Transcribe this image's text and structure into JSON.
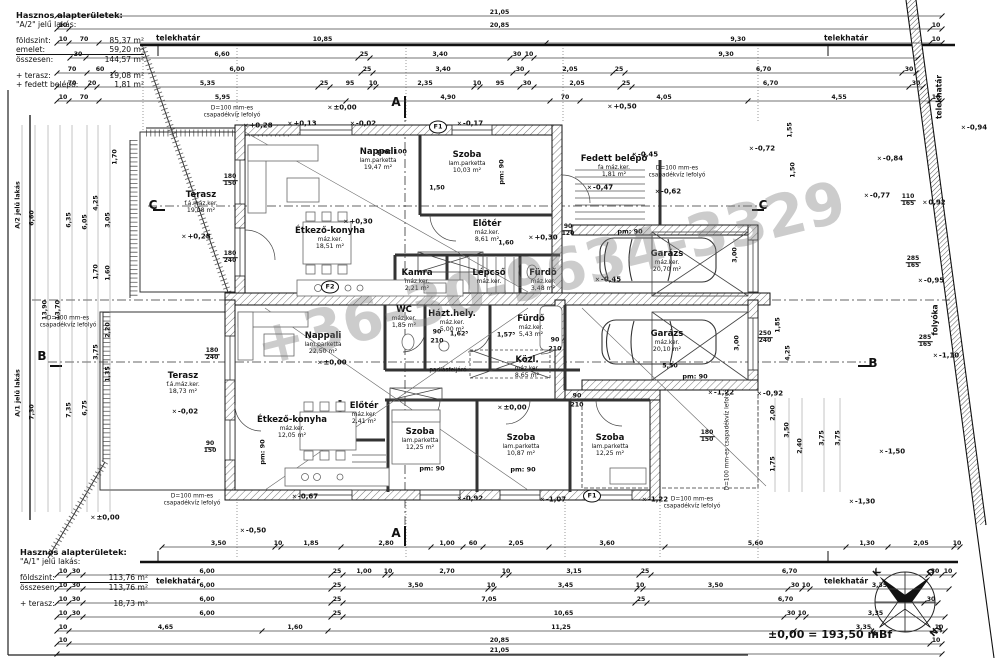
{
  "watermark": {
    "text": "+36-30-9634-3329"
  },
  "datum_note": "±0,00 = 193,50 mBf",
  "info_top": {
    "title": "Hasznos alapterületek:",
    "subtitle": "\"A/2\" jelű lakás:",
    "rows": [
      {
        "label": "földszint:",
        "value": "85,37 m²",
        "underline": false
      },
      {
        "label": "emelet:",
        "value": "59,20 m²",
        "underline": true
      },
      {
        "label": "összesen:",
        "value": "144,57 m²",
        "underline": false
      }
    ],
    "extras": [
      {
        "label": "+ terasz:",
        "value": "19,08 m²"
      },
      {
        "label": "+ fedett belépő:",
        "value": "1,81 m²"
      }
    ]
  },
  "info_bottom": {
    "title": "Hasznos alapterületek:",
    "subtitle": "\"A/1\" jelű lakás:",
    "rows": [
      {
        "label": "földszint:",
        "value": "113,76 m²",
        "underline": true
      },
      {
        "label": "összesen:",
        "value": "113,76 m²",
        "underline": false
      }
    ],
    "extras": [
      {
        "label": "+ terasz:",
        "value": "18,73 m²"
      }
    ]
  },
  "compass": {
    "n": "É",
    "e": "K",
    "s": "D",
    "w": "Ny"
  },
  "rooms": [
    {
      "n": "Nappali",
      "f": "lam.parketta",
      "a": "19,47 m²",
      "x": 378,
      "y": 160
    },
    {
      "n": "Szoba",
      "f": "lam.parketta",
      "a": "10,03 m²",
      "x": 467,
      "y": 163
    },
    {
      "n": "Étkező-konyha",
      "f": "máz.ker.",
      "a": "18,51 m²",
      "x": 330,
      "y": 239
    },
    {
      "n": "Előtér",
      "f": "máz.ker.",
      "a": "8,61 m²",
      "x": 487,
      "y": 232
    },
    {
      "n": "Kamra",
      "f": "máz.ker.",
      "a": "2,21 m²",
      "x": 417,
      "y": 281
    },
    {
      "n": "Lépcső",
      "f": "máz.ker.",
      "a": "",
      "x": 489,
      "y": 277
    },
    {
      "n": "Fürdő",
      "f": "máz.ker.",
      "a": "3,48 m²",
      "x": 543,
      "y": 281
    },
    {
      "n": "Fedett belépő",
      "f": "fa máz.ker.",
      "a": "1,81 m²",
      "x": 614,
      "y": 167
    },
    {
      "n": "Garázs",
      "f": "máz.ker.",
      "a": "20,70 m²",
      "x": 667,
      "y": 262
    },
    {
      "n": "Garázs",
      "f": "máz.ker.",
      "a": "20,10 m²",
      "x": 667,
      "y": 342
    },
    {
      "n": "Terasz",
      "f": "f.á.máz.ker.",
      "a": "19,08 m²",
      "x": 201,
      "y": 203
    },
    {
      "n": "Terasz",
      "f": "f.á.máz.ker.",
      "a": "18,73 m²",
      "x": 183,
      "y": 384
    },
    {
      "n": "Nappali",
      "f": "lam.parketta",
      "a": "22,50 m²",
      "x": 323,
      "y": 344
    },
    {
      "n": "Étkező-konyha",
      "f": "máz.ker.",
      "a": "12,05 m²",
      "x": 292,
      "y": 428
    },
    {
      "n": "Előtér",
      "f": "máz.ker.",
      "a": "2,41 m²",
      "x": 364,
      "y": 414
    },
    {
      "n": "WC",
      "f": "máz.ker.",
      "a": "1,85 m²",
      "x": 404,
      "y": 318
    },
    {
      "n": "Házt.hely.",
      "f": "máz.ker.",
      "a": "5,00 m²",
      "x": 452,
      "y": 322
    },
    {
      "n": "Fürdő",
      "f": "máz.ker.",
      "a": "5,43 m²",
      "x": 531,
      "y": 327
    },
    {
      "n": "Közl.",
      "f": "máz.ker.",
      "a": "8,65 m²",
      "x": 527,
      "y": 368
    },
    {
      "n": "Szoba",
      "f": "lam.parketta",
      "a": "12,25 m²",
      "x": 420,
      "y": 440
    },
    {
      "n": "Szoba",
      "f": "lam.parketta",
      "a": "10,87 m²",
      "x": 521,
      "y": 446
    },
    {
      "n": "Szoba",
      "f": "lam.parketta",
      "a": "12,25 m²",
      "x": 610,
      "y": 446
    }
  ],
  "levels": [
    {
      "t": "+0,28",
      "x": 258,
      "y": 126
    },
    {
      "t": "+0,13",
      "x": 302,
      "y": 124
    },
    {
      "t": "-0,02",
      "x": 363,
      "y": 124
    },
    {
      "t": "-0,17",
      "x": 470,
      "y": 124
    },
    {
      "t": "±0,00",
      "x": 342,
      "y": 108
    },
    {
      "t": "+0,50",
      "x": 622,
      "y": 107
    },
    {
      "t": "+0,30",
      "x": 358,
      "y": 222
    },
    {
      "t": "+0,28",
      "x": 196,
      "y": 237
    },
    {
      "t": "-0,02",
      "x": 185,
      "y": 412
    },
    {
      "t": "+0,30",
      "x": 543,
      "y": 238
    },
    {
      "t": "-0,45",
      "x": 608,
      "y": 280
    },
    {
      "t": "-0,47",
      "x": 600,
      "y": 188
    },
    {
      "t": "-0,62",
      "x": 668,
      "y": 192
    },
    {
      "t": "-0,72",
      "x": 762,
      "y": 149
    },
    {
      "t": "-0,84",
      "x": 890,
      "y": 159
    },
    {
      "t": "-0,94",
      "x": 974,
      "y": 128
    },
    {
      "t": "-0,77",
      "x": 877,
      "y": 196
    },
    {
      "t": "-0,95",
      "x": 931,
      "y": 281
    },
    {
      "t": "-1,10",
      "x": 946,
      "y": 356
    },
    {
      "t": "-1,50",
      "x": 892,
      "y": 452
    },
    {
      "t": "±0,00",
      "x": 512,
      "y": 408
    },
    {
      "t": "±0,00",
      "x": 332,
      "y": 363
    },
    {
      "t": "-0,50",
      "x": 253,
      "y": 531
    },
    {
      "t": "-0,67",
      "x": 305,
      "y": 497
    },
    {
      "t": "-0,92",
      "x": 470,
      "y": 499
    },
    {
      "t": "-1,07",
      "x": 553,
      "y": 500
    },
    {
      "t": "-1,22",
      "x": 655,
      "y": 500
    },
    {
      "t": "-1,22",
      "x": 721,
      "y": 393
    },
    {
      "t": "-0,92",
      "x": 770,
      "y": 394
    },
    {
      "t": "-1,30",
      "x": 862,
      "y": 502
    },
    {
      "t": "±0,00",
      "x": 105,
      "y": 518
    },
    {
      "t": "-0,45",
      "x": 645,
      "y": 155
    },
    {
      "t": "0,92",
      "x": 934,
      "y": 203
    }
  ],
  "texts": [
    {
      "t": "telekhatár",
      "x": 178,
      "y": 39,
      "cls": "site"
    },
    {
      "t": "telekhatár",
      "x": 846,
      "y": 39,
      "cls": "site"
    },
    {
      "t": "telekhatár",
      "x": 178,
      "y": 582,
      "cls": "site"
    },
    {
      "t": "telekhatár",
      "x": 846,
      "y": 582,
      "cls": "site"
    },
    {
      "t": "telekhatár",
      "x": 940,
      "y": 97,
      "cls": "site",
      "v": 1
    },
    {
      "t": "folyóka",
      "x": 936,
      "y": 320,
      "cls": "site",
      "v": 1
    },
    {
      "t": "D=100 mm-es\ncsapadékvíz lefolyó",
      "x": 232,
      "y": 112,
      "cls": "note"
    },
    {
      "t": "D=100 mm-es\ncsapadékvíz lefolyó",
      "x": 677,
      "y": 172,
      "cls": "note"
    },
    {
      "t": "D=100 mm-es\ncsapadékvíz lefolyó",
      "x": 68,
      "y": 322,
      "cls": "note"
    },
    {
      "t": "D=100 mm-es\ncsapadékvíz lefolyó",
      "x": 192,
      "y": 500,
      "cls": "note"
    },
    {
      "t": "D=100 mm-es\ncsapadékvíz lefolyó",
      "x": 692,
      "y": 503,
      "cls": "note"
    },
    {
      "t": "D=100 mm-es\ncsapadékvíz lefolyó",
      "x": 728,
      "y": 440,
      "cls": "note",
      "v": 1
    },
    {
      "t": "padlásfeljáró",
      "x": 448,
      "y": 371,
      "cls": "note"
    },
    {
      "t": "pm: 100",
      "x": 392,
      "y": 152,
      "cls": "pm"
    },
    {
      "t": "pm: 90",
      "x": 630,
      "y": 232,
      "cls": "pm"
    },
    {
      "t": "pm: 90",
      "x": 432,
      "y": 469,
      "cls": "pm"
    },
    {
      "t": "pm: 90",
      "x": 523,
      "y": 470,
      "cls": "pm"
    },
    {
      "t": "pm: 90",
      "x": 695,
      "y": 377,
      "cls": "pm"
    },
    {
      "t": "pm: 90",
      "x": 502,
      "y": 172,
      "cls": "pm",
      "v": 1
    },
    {
      "t": "pm: 90",
      "x": 263,
      "y": 452,
      "cls": "pm",
      "v": 1
    },
    {
      "t": "1,50",
      "x": 437,
      "y": 188,
      "cls": "dimtxt"
    },
    {
      "t": "1,62⁵",
      "x": 459,
      "y": 334,
      "cls": "dimtxt"
    },
    {
      "t": "1,57⁵",
      "x": 506,
      "y": 335,
      "cls": "dimtxt"
    },
    {
      "t": "5,50",
      "x": 670,
      "y": 366,
      "cls": "dimtxt"
    },
    {
      "t": "1,60",
      "x": 506,
      "y": 243,
      "cls": "dimtxt"
    },
    {
      "t": "90",
      "x": 555,
      "y": 340,
      "cls": "dimtxt"
    },
    {
      "t": "210",
      "x": 555,
      "y": 349,
      "cls": "dimtxt"
    },
    {
      "t": "90",
      "x": 577,
      "y": 396,
      "cls": "dimtxt"
    },
    {
      "t": "210",
      "x": 577,
      "y": 405,
      "cls": "dimtxt"
    },
    {
      "t": "90",
      "x": 437,
      "y": 332,
      "cls": "dimtxt"
    },
    {
      "t": "210",
      "x": 437,
      "y": 341,
      "cls": "dimtxt"
    },
    {
      "t": "A/2 jelű lakás",
      "x": 18,
      "y": 205,
      "cls": "dimtxt",
      "v": 1
    },
    {
      "t": "6,60",
      "x": 32,
      "y": 218,
      "cls": "dimtxt",
      "v": 1
    },
    {
      "t": "13,90",
      "x": 45,
      "y": 310,
      "cls": "dimtxt",
      "v": 1
    },
    {
      "t": "13,70",
      "x": 58,
      "y": 310,
      "cls": "dimtxt",
      "v": 1
    },
    {
      "t": "6,35",
      "x": 69,
      "y": 220,
      "cls": "dimtxt",
      "v": 1
    },
    {
      "t": "6,05",
      "x": 85,
      "y": 222,
      "cls": "dimtxt",
      "v": 1
    },
    {
      "t": "4,25",
      "x": 96,
      "y": 203,
      "cls": "dimtxt",
      "v": 1
    },
    {
      "t": "3,05",
      "x": 108,
      "y": 220,
      "cls": "dimtxt",
      "v": 1
    },
    {
      "t": "1,70",
      "x": 96,
      "y": 272,
      "cls": "dimtxt",
      "v": 1
    },
    {
      "t": "1,60",
      "x": 108,
      "y": 273,
      "cls": "dimtxt",
      "v": 1
    },
    {
      "t": "1,70",
      "x": 115,
      "y": 157,
      "cls": "dimtxt",
      "v": 1
    },
    {
      "t": "A/1 jelű lakás",
      "x": 18,
      "y": 393,
      "cls": "dimtxt",
      "v": 1
    },
    {
      "t": "7,30",
      "x": 32,
      "y": 412,
      "cls": "dimtxt",
      "v": 1
    },
    {
      "t": "7,35",
      "x": 69,
      "y": 410,
      "cls": "dimtxt",
      "v": 1
    },
    {
      "t": "6,75",
      "x": 85,
      "y": 408,
      "cls": "dimtxt",
      "v": 1
    },
    {
      "t": "3,75",
      "x": 96,
      "y": 352,
      "cls": "dimtxt",
      "v": 1
    },
    {
      "t": "2,20",
      "x": 108,
      "y": 330,
      "cls": "dimtxt",
      "v": 1
    },
    {
      "t": "1,35",
      "x": 108,
      "y": 374,
      "cls": "dimtxt",
      "v": 1
    },
    {
      "t": "2,00",
      "x": 773,
      "y": 413,
      "cls": "dimtxt",
      "v": 1
    },
    {
      "t": "3,50",
      "x": 787,
      "y": 430,
      "cls": "dimtxt",
      "v": 1
    },
    {
      "t": "2,40",
      "x": 800,
      "y": 446,
      "cls": "dimtxt",
      "v": 1
    },
    {
      "t": "3,75",
      "x": 822,
      "y": 438,
      "cls": "dimtxt",
      "v": 1
    },
    {
      "t": "3,75",
      "x": 838,
      "y": 438,
      "cls": "dimtxt",
      "v": 1
    },
    {
      "t": "1,75",
      "x": 773,
      "y": 464,
      "cls": "dimtxt",
      "v": 1
    },
    {
      "t": "1,55",
      "x": 790,
      "y": 130,
      "cls": "dimtxt",
      "v": 1
    },
    {
      "t": "1,50",
      "x": 793,
      "y": 170,
      "cls": "dimtxt",
      "v": 1
    },
    {
      "t": "1,85",
      "x": 778,
      "y": 325,
      "cls": "dimtxt",
      "v": 1
    },
    {
      "t": "4,25",
      "x": 788,
      "y": 353,
      "cls": "dimtxt",
      "v": 1
    },
    {
      "t": "3,00",
      "x": 737,
      "y": 343,
      "cls": "dimtxt",
      "v": 1
    },
    {
      "t": "3,00",
      "x": 735,
      "y": 255,
      "cls": "dimtxt",
      "v": 1
    }
  ],
  "fractions": [
    {
      "a": "180",
      "b": "150",
      "x": 230,
      "y": 181
    },
    {
      "a": "180",
      "b": "240",
      "x": 230,
      "y": 258
    },
    {
      "a": "180",
      "b": "240",
      "x": 212,
      "y": 355
    },
    {
      "a": "90",
      "b": "150",
      "x": 210,
      "y": 448
    },
    {
      "a": "110",
      "b": "165",
      "x": 908,
      "y": 201
    },
    {
      "a": "285",
      "b": "165",
      "x": 913,
      "y": 263
    },
    {
      "a": "285",
      "b": "165",
      "x": 925,
      "y": 342
    },
    {
      "a": "250",
      "b": "240",
      "x": 765,
      "y": 338
    },
    {
      "a": "90",
      "b": "120",
      "x": 568,
      "y": 231
    },
    {
      "a": "180",
      "b": "150",
      "x": 707,
      "y": 437
    }
  ],
  "circles": [
    {
      "t": "F1",
      "x": 438,
      "y": 127
    },
    {
      "t": "F2",
      "x": 330,
      "y": 287
    },
    {
      "t": "F1",
      "x": 592,
      "y": 496
    }
  ],
  "sections": [
    {
      "t": "A",
      "x": 396,
      "y": 103
    },
    {
      "t": "A",
      "x": 396,
      "y": 534
    },
    {
      "t": "B",
      "x": 42,
      "y": 357
    },
    {
      "t": "B",
      "x": 873,
      "y": 364
    },
    {
      "t": "C",
      "x": 153,
      "y": 206
    },
    {
      "t": "C",
      "x": 763,
      "y": 206
    }
  ],
  "chains_h": [
    {
      "x": 57,
      "y": 16,
      "segs": [
        [
          "21,05",
          885
        ]
      ]
    },
    {
      "x": 57,
      "y": 29,
      "segs": [
        [
          "10",
          12
        ],
        [
          "20,85",
          861
        ],
        [
          "10",
          12
        ]
      ]
    },
    {
      "x": 57,
      "y": 43,
      "segs": [
        [
          "10",
          12
        ],
        [
          "70",
          30
        ],
        [
          "10,85",
          447
        ],
        [
          "9,30",
          384
        ],
        [
          "10",
          12
        ]
      ]
    },
    {
      "x": 70,
      "y": 58,
      "segs": [
        [
          "30",
          16
        ],
        [
          "6,60",
          272
        ],
        [
          "25",
          12
        ],
        [
          "3,40",
          140
        ],
        [
          "30",
          14
        ],
        [
          "10",
          10
        ],
        [
          "9,30",
          384
        ]
      ]
    },
    {
      "x": 57,
      "y": 73,
      "segs": [
        [
          "70",
          30
        ],
        [
          "60",
          26
        ],
        [
          "6,00",
          248
        ],
        [
          "25",
          12
        ],
        [
          "3,40",
          140
        ],
        [
          "30",
          14
        ],
        [
          "2,05",
          86
        ],
        [
          "25",
          12
        ],
        [
          "6,70",
          277
        ],
        [
          "30",
          14
        ]
      ]
    },
    {
      "x": 57,
      "y": 87,
      "segs": [
        [
          "70",
          30
        ],
        [
          "20",
          10
        ],
        [
          "5,35",
          221
        ],
        [
          "25",
          12
        ],
        [
          "95",
          40
        ],
        [
          "10",
          6
        ],
        [
          "2,35",
          98
        ],
        [
          "10",
          6
        ],
        [
          "95",
          40
        ],
        [
          "30",
          14
        ],
        [
          "2,05",
          86
        ],
        [
          "25",
          12
        ],
        [
          "6,70",
          277
        ],
        [
          "30",
          14
        ]
      ]
    },
    {
      "x": 57,
      "y": 101,
      "segs": [
        [
          "10",
          12
        ],
        [
          "70",
          30
        ],
        [
          "5,95",
          247
        ],
        [
          "4,90",
          204
        ],
        [
          "70",
          30
        ],
        [
          "4,05",
          168
        ],
        [
          "4,55",
          182
        ],
        [
          "10",
          12
        ]
      ]
    },
    {
      "x": 162,
      "y": 547,
      "segs": [
        [
          "3,50",
          113
        ],
        [
          "10",
          6
        ],
        [
          "1,85",
          60
        ],
        [
          "2,80",
          90
        ],
        [
          "1,00",
          32
        ],
        [
          "60",
          20
        ],
        [
          "2,05",
          66
        ],
        [
          "3,60",
          116
        ],
        [
          "5,60",
          181
        ],
        [
          "1,30",
          42
        ],
        [
          "2,05",
          66
        ],
        [
          "10",
          6
        ]
      ]
    },
    {
      "x": 57,
      "y": 575,
      "segs": [
        [
          "10",
          12
        ],
        [
          "30",
          14
        ],
        [
          "6,00",
          248
        ],
        [
          "25",
          12
        ],
        [
          "1,00",
          42
        ],
        [
          "10",
          6
        ],
        [
          "2,70",
          112
        ],
        [
          "10",
          6
        ],
        [
          "3,15",
          130
        ],
        [
          "25",
          12
        ],
        [
          "6,70",
          277
        ],
        [
          "30",
          14
        ],
        [
          "10",
          12
        ]
      ]
    },
    {
      "x": 57,
      "y": 589,
      "segs": [
        [
          "10",
          12
        ],
        [
          "30",
          14
        ],
        [
          "6,00",
          248
        ],
        [
          "25",
          12
        ],
        [
          "3,50",
          145
        ],
        [
          "10",
          6
        ],
        [
          "3,45",
          143
        ],
        [
          "10",
          6
        ],
        [
          "3,50",
          145
        ],
        [
          "30",
          14
        ],
        [
          "10",
          8
        ],
        [
          "3,35",
          139
        ]
      ]
    },
    {
      "x": 57,
      "y": 603,
      "segs": [
        [
          "10",
          12
        ],
        [
          "30",
          14
        ],
        [
          "6,00",
          248
        ],
        [
          "25",
          12
        ],
        [
          "7,05",
          292
        ],
        [
          "25",
          12
        ],
        [
          "6,70",
          277
        ],
        [
          "30",
          14
        ]
      ]
    },
    {
      "x": 57,
      "y": 617,
      "segs": [
        [
          "10",
          12
        ],
        [
          "30",
          14
        ],
        [
          "6,00",
          248
        ],
        [
          "25",
          12
        ],
        [
          "10,65",
          441
        ],
        [
          "30",
          14
        ],
        [
          "10",
          8
        ],
        [
          "3,35",
          139
        ]
      ]
    },
    {
      "x": 57,
      "y": 631,
      "segs": [
        [
          "10",
          12
        ],
        [
          "4,65",
          193
        ],
        [
          "1,60",
          66
        ],
        [
          "11,25",
          466
        ],
        [
          "3,35",
          139
        ],
        [
          "10",
          12
        ]
      ]
    },
    {
      "x": 57,
      "y": 644,
      "segs": [
        [
          "10",
          12
        ],
        [
          "20,85",
          861
        ],
        [
          "10",
          12
        ]
      ]
    },
    {
      "x": 57,
      "y": 654,
      "segs": [
        [
          "21,05",
          885
        ]
      ]
    }
  ]
}
